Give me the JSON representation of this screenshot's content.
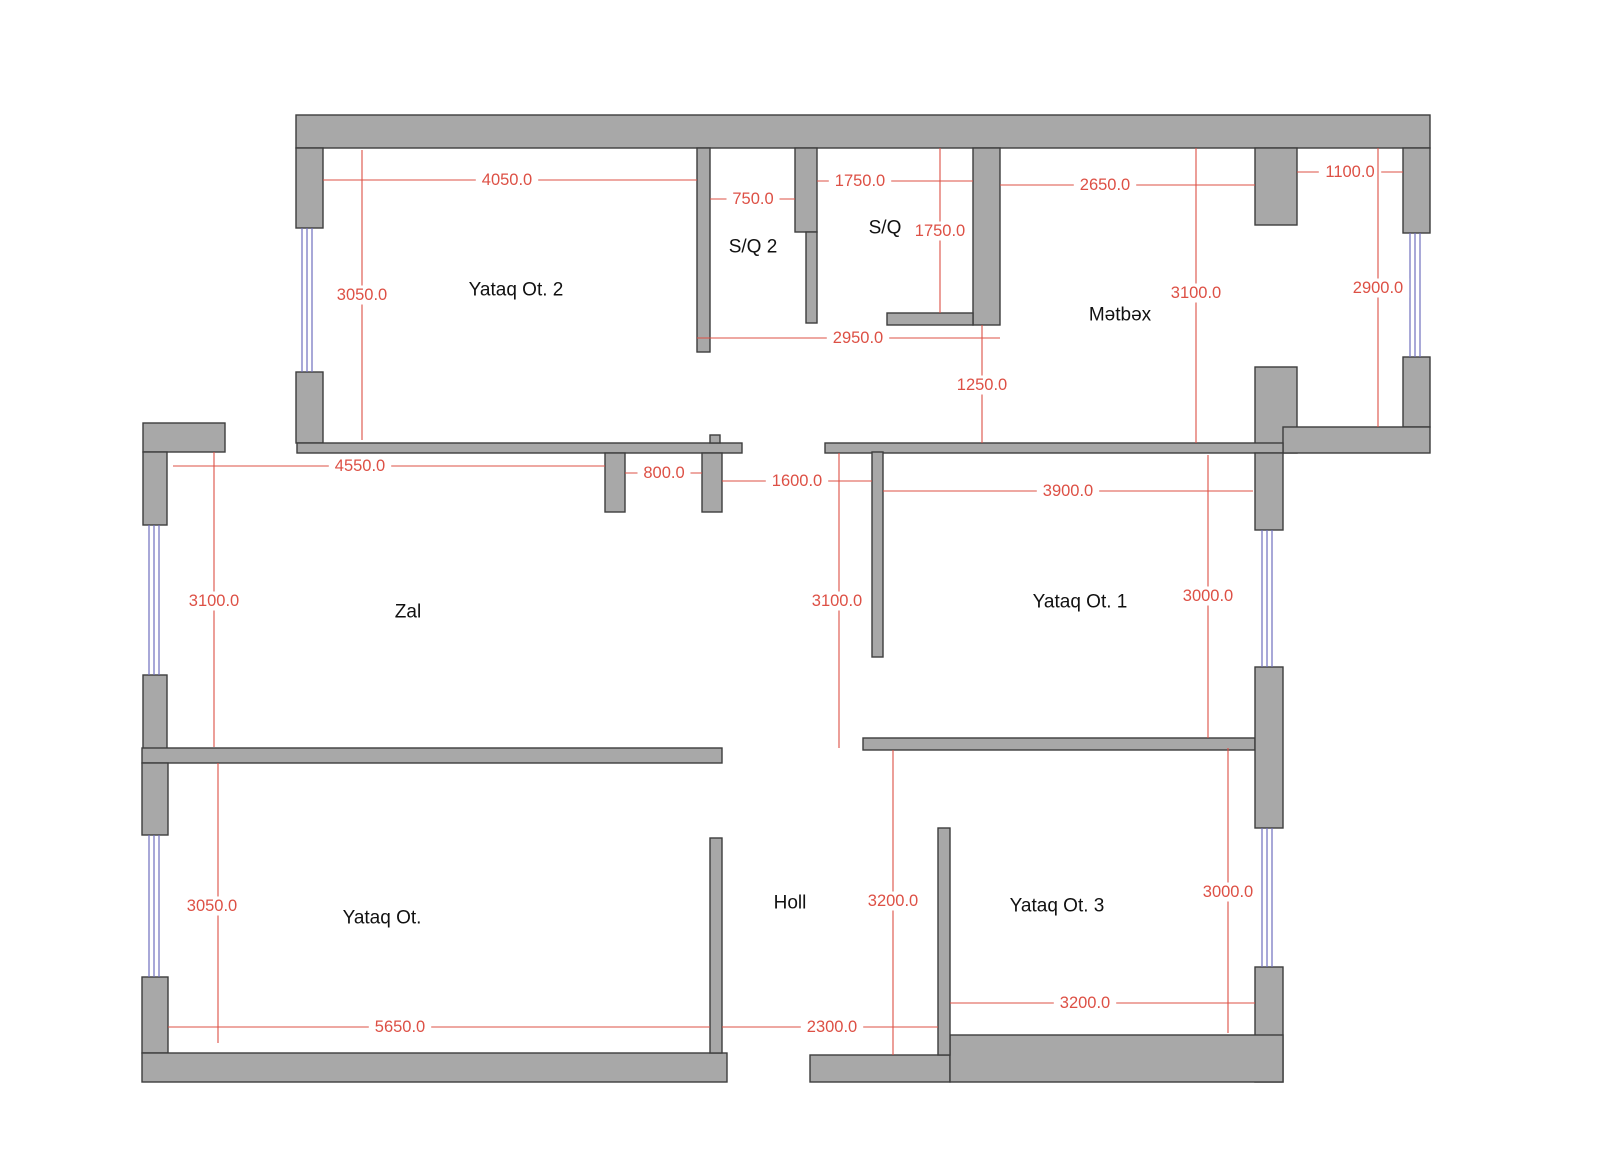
{
  "document": {
    "type": "apartment-floor-plan",
    "canvas": {
      "width": 1600,
      "height": 1158,
      "background": "#ffffff"
    }
  },
  "colors": {
    "wall_fill": "#a8a8a8",
    "wall_stroke": "#3d3d3d",
    "dimension": "#dd5045",
    "window": "#6f6fbe",
    "room_text": "#111111",
    "bg": "#ffffff"
  },
  "rooms": [
    {
      "name": "Yataq Ot. 2",
      "x": 516,
      "y": 290
    },
    {
      "name": "S/Q 2",
      "x": 753,
      "y": 247
    },
    {
      "name": "S/Q",
      "x": 885,
      "y": 228
    },
    {
      "name": "Mətbəx",
      "x": 1120,
      "y": 315
    },
    {
      "name": "Zal",
      "x": 408,
      "y": 612
    },
    {
      "name": "Yataq Ot. 1",
      "x": 1080,
      "y": 602
    },
    {
      "name": "Yataq Ot.",
      "x": 382,
      "y": 918
    },
    {
      "name": "Holl",
      "x": 790,
      "y": 903
    },
    {
      "name": "Yataq Ot. 3",
      "x": 1057,
      "y": 906
    }
  ],
  "walls": [
    {
      "x": 296,
      "y": 115,
      "w": 1134,
      "h": 33
    },
    {
      "x": 296,
      "y": 148,
      "w": 27,
      "h": 80
    },
    {
      "x": 296,
      "y": 372,
      "w": 27,
      "h": 71
    },
    {
      "x": 697,
      "y": 148,
      "w": 13,
      "h": 204
    },
    {
      "x": 795,
      "y": 148,
      "w": 22,
      "h": 84
    },
    {
      "x": 806,
      "y": 232,
      "w": 11,
      "h": 91
    },
    {
      "x": 973,
      "y": 148,
      "w": 27,
      "h": 177
    },
    {
      "x": 887,
      "y": 313,
      "w": 86,
      "h": 12
    },
    {
      "x": 1255,
      "y": 148,
      "w": 42,
      "h": 77
    },
    {
      "x": 1255,
      "y": 367,
      "w": 42,
      "h": 86
    },
    {
      "x": 1403,
      "y": 148,
      "w": 27,
      "h": 85
    },
    {
      "x": 1403,
      "y": 357,
      "w": 27,
      "h": 70
    },
    {
      "x": 1283,
      "y": 427,
      "w": 147,
      "h": 26
    },
    {
      "x": 297,
      "y": 443,
      "w": 445,
      "h": 10
    },
    {
      "x": 825,
      "y": 443,
      "w": 458,
      "h": 10
    },
    {
      "x": 605,
      "y": 453,
      "w": 20,
      "h": 59
    },
    {
      "x": 702,
      "y": 453,
      "w": 20,
      "h": 59
    },
    {
      "x": 710,
      "y": 435,
      "w": 10,
      "h": 8
    },
    {
      "x": 143,
      "y": 423,
      "w": 82,
      "h": 29
    },
    {
      "x": 143,
      "y": 452,
      "w": 24,
      "h": 73
    },
    {
      "x": 143,
      "y": 675,
      "w": 24,
      "h": 75
    },
    {
      "x": 142,
      "y": 748,
      "w": 580,
      "h": 15
    },
    {
      "x": 872,
      "y": 452,
      "w": 11,
      "h": 205
    },
    {
      "x": 863,
      "y": 738,
      "w": 392,
      "h": 12
    },
    {
      "x": 1255,
      "y": 453,
      "w": 28,
      "h": 77
    },
    {
      "x": 1255,
      "y": 667,
      "w": 28,
      "h": 161
    },
    {
      "x": 1255,
      "y": 967,
      "w": 28,
      "h": 115
    },
    {
      "x": 142,
      "y": 763,
      "w": 26,
      "h": 72
    },
    {
      "x": 142,
      "y": 977,
      "w": 26,
      "h": 76
    },
    {
      "x": 142,
      "y": 1053,
      "w": 585,
      "h": 29
    },
    {
      "x": 810,
      "y": 1055,
      "w": 140,
      "h": 27
    },
    {
      "x": 950,
      "y": 1035,
      "w": 333,
      "h": 47
    },
    {
      "x": 710,
      "y": 838,
      "w": 12,
      "h": 215
    },
    {
      "x": 938,
      "y": 828,
      "w": 12,
      "h": 227
    }
  ],
  "windows": [
    {
      "orient": "v",
      "center": 307,
      "from": 228,
      "to": 372
    },
    {
      "orient": "v",
      "center": 154,
      "from": 525,
      "to": 675
    },
    {
      "orient": "v",
      "center": 154,
      "from": 835,
      "to": 977
    },
    {
      "orient": "v",
      "center": 1415,
      "from": 233,
      "to": 357
    },
    {
      "orient": "v",
      "center": 1267,
      "from": 530,
      "to": 667
    },
    {
      "orient": "v",
      "center": 1267,
      "from": 828,
      "to": 967
    }
  ],
  "dimensions": [
    {
      "value": "4050.0",
      "orient": "h",
      "pos": 180,
      "from": 323,
      "to": 697,
      "label_x": 507,
      "label_y": 180
    },
    {
      "value": "750.0",
      "orient": "h",
      "pos": 199,
      "from": 710,
      "to": 795,
      "label_x": 753,
      "label_y": 199
    },
    {
      "value": "1750.0",
      "orient": "h",
      "pos": 181,
      "from": 817,
      "to": 973,
      "label_x": 860,
      "label_y": 181
    },
    {
      "value": "2650.0",
      "orient": "h",
      "pos": 185,
      "from": 1000,
      "to": 1255,
      "label_x": 1105,
      "label_y": 185
    },
    {
      "value": "1100.0",
      "orient": "h",
      "pos": 172,
      "from": 1297,
      "to": 1403,
      "label_x": 1350,
      "label_y": 172
    },
    {
      "value": "2950.0",
      "orient": "h",
      "pos": 338,
      "from": 697,
      "to": 1000,
      "label_x": 858,
      "label_y": 338
    },
    {
      "value": "4550.0",
      "orient": "h",
      "pos": 466,
      "from": 173,
      "to": 605,
      "label_x": 360,
      "label_y": 466
    },
    {
      "value": "800.0",
      "orient": "h",
      "pos": 473,
      "from": 625,
      "to": 702,
      "label_x": 664,
      "label_y": 473
    },
    {
      "value": "1600.0",
      "orient": "h",
      "pos": 481,
      "from": 722,
      "to": 872,
      "label_x": 797,
      "label_y": 481
    },
    {
      "value": "3900.0",
      "orient": "h",
      "pos": 491,
      "from": 883,
      "to": 1253,
      "label_x": 1068,
      "label_y": 491
    },
    {
      "value": "5650.0",
      "orient": "h",
      "pos": 1027,
      "from": 168,
      "to": 710,
      "label_x": 400,
      "label_y": 1027
    },
    {
      "value": "2300.0",
      "orient": "h",
      "pos": 1027,
      "from": 722,
      "to": 938,
      "label_x": 832,
      "label_y": 1027
    },
    {
      "value": "3200.0",
      "orient": "h",
      "pos": 1003,
      "from": 950,
      "to": 1255,
      "label_x": 1085,
      "label_y": 1003
    },
    {
      "value": "3050.0",
      "orient": "v",
      "pos": 362,
      "from": 150,
      "to": 440,
      "label_x": 362,
      "label_y": 295
    },
    {
      "value": "1750.0",
      "orient": "v",
      "pos": 940,
      "from": 148,
      "to": 313,
      "label_x": 940,
      "label_y": 231
    },
    {
      "value": "3100.0",
      "orient": "v",
      "pos": 1196,
      "from": 148,
      "to": 443,
      "label_x": 1196,
      "label_y": 293
    },
    {
      "value": "2900.0",
      "orient": "v",
      "pos": 1378,
      "from": 148,
      "to": 427,
      "label_x": 1378,
      "label_y": 288
    },
    {
      "value": "1250.0",
      "orient": "v",
      "pos": 982,
      "from": 325,
      "to": 443,
      "label_x": 982,
      "label_y": 385
    },
    {
      "value": "3100.0",
      "orient": "v",
      "pos": 214,
      "from": 452,
      "to": 747,
      "label_x": 214,
      "label_y": 601
    },
    {
      "value": "3100.0",
      "orient": "v",
      "pos": 839,
      "from": 453,
      "to": 748,
      "label_x": 837,
      "label_y": 601
    },
    {
      "value": "3000.0",
      "orient": "v",
      "pos": 1208,
      "from": 455,
      "to": 738,
      "label_x": 1208,
      "label_y": 596
    },
    {
      "value": "3050.0",
      "orient": "v",
      "pos": 218,
      "from": 763,
      "to": 1043,
      "label_x": 212,
      "label_y": 906
    },
    {
      "value": "3200.0",
      "orient": "v",
      "pos": 893,
      "from": 750,
      "to": 1055,
      "label_x": 893,
      "label_y": 901
    },
    {
      "value": "3000.0",
      "orient": "v",
      "pos": 1228,
      "from": 748,
      "to": 1033,
      "label_x": 1228,
      "label_y": 892
    }
  ],
  "style": {
    "room_font_size": 19,
    "dim_font_size": 16.5,
    "wall_stroke_width": 1.4,
    "dim_stroke_width": 1.1,
    "window_stroke_width": 1.2,
    "window_line_offsets": [
      -5,
      0,
      5
    ]
  }
}
